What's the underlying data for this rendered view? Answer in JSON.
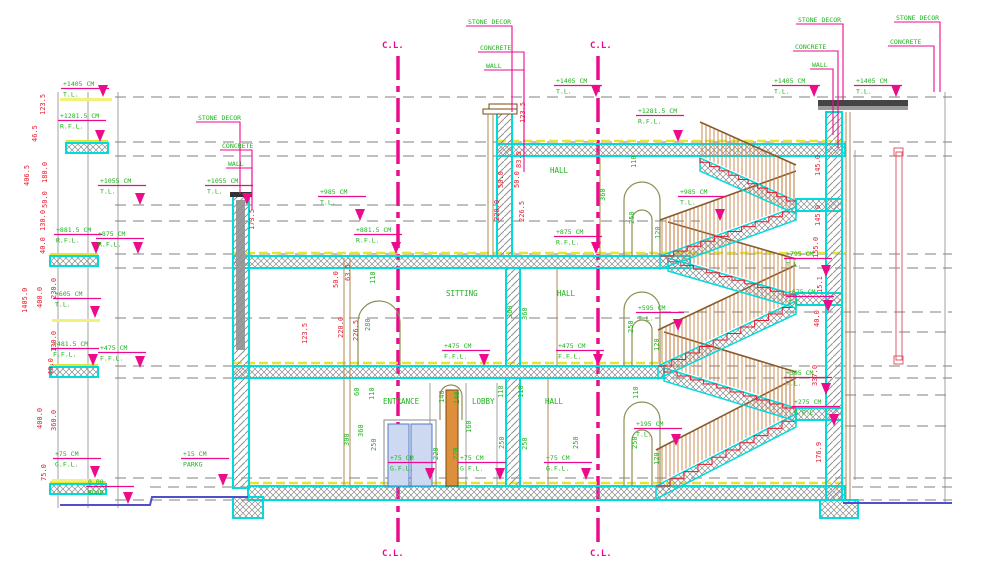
{
  "drawing": {
    "type": "architectural-section",
    "units": "CM"
  },
  "colors": {
    "level_text": "#1db31d",
    "dim_red": "#e8192c",
    "marker_magenta": "#ec0b8b",
    "slab_cyan": "#00dcdc",
    "floor_yellow": "#e4e432",
    "road_blue": "#5050c8",
    "stair_wood": "#c8834a",
    "column_orange": "#dd8f3c"
  },
  "centerlines": [
    {
      "t": "C.L.",
      "x": 382,
      "y": 48
    },
    {
      "t": "C.L.",
      "x": 590,
      "y": 48
    },
    {
      "t": "C.L.",
      "x": 382,
      "y": 556
    },
    {
      "t": "C.L.",
      "x": 590,
      "y": 556
    }
  ],
  "rooms": [
    {
      "t": "HALL",
      "x": 550,
      "y": 173
    },
    {
      "t": "SITTING",
      "x": 446,
      "y": 296
    },
    {
      "t": "HALL",
      "x": 557,
      "y": 296
    },
    {
      "t": "ENTRANCE",
      "x": 383,
      "y": 404
    },
    {
      "t": "LOBBY",
      "x": 472,
      "y": 404
    },
    {
      "t": "HALL",
      "x": 545,
      "y": 404
    }
  ],
  "levels": [
    {
      "v": "+1405 CM",
      "l": "T.L.",
      "x": 63,
      "y": 86,
      "ty": 97
    },
    {
      "v": "+1281.5 CM",
      "l": "R.F.L.",
      "x": 60,
      "y": 118,
      "ty": 142
    },
    {
      "v": "+1055 CM",
      "l": "T.L.",
      "x": 100,
      "y": 183,
      "ty": 205
    },
    {
      "v": "+1055 CM",
      "l": "T.L.",
      "x": 207,
      "y": 183,
      "ty": 205
    },
    {
      "v": "+881.5 CM",
      "l": "R.F.L.",
      "x": 56,
      "y": 232,
      "ty": 254
    },
    {
      "v": "+875 CM",
      "l": "R.F.L.",
      "x": 98,
      "y": 236,
      "ty": 254
    },
    {
      "v": "+605 CM",
      "l": "T.L.",
      "x": 55,
      "y": 296,
      "ty": 318
    },
    {
      "v": "+481.5 CM",
      "l": "F.F.L.",
      "x": 53,
      "y": 346,
      "ty": 366
    },
    {
      "v": "+475 CM",
      "l": "F.F.L.",
      "x": 100,
      "y": 350,
      "ty": 368
    },
    {
      "v": "+75 CM",
      "l": "G.F.L.",
      "x": 55,
      "y": 456,
      "ty": 478
    },
    {
      "v": "0.00",
      "l": "ROAD",
      "x": 88,
      "y": 484,
      "ty": 504
    },
    {
      "v": "+15 CM",
      "l": "PARKG",
      "x": 183,
      "y": 456,
      "ty": 486
    },
    {
      "v": "+1405 CM",
      "l": "T.L.",
      "x": 556,
      "y": 83,
      "ty": 97
    },
    {
      "v": "+1405 CM",
      "l": "T.L.",
      "x": 774,
      "y": 83,
      "ty": 97
    },
    {
      "v": "+1405 CM",
      "l": "T.L.",
      "x": 856,
      "y": 83,
      "ty": 97
    },
    {
      "v": "+1281.5 CM",
      "l": "R.F.L.",
      "x": 638,
      "y": 113,
      "ty": 142
    },
    {
      "v": "+985 CM",
      "l": "T.L.",
      "x": 320,
      "y": 194,
      "ty": 221
    },
    {
      "v": "+985 CM",
      "l": "T.L.",
      "x": 680,
      "y": 194,
      "ty": 221
    },
    {
      "v": "+881.5 CM",
      "l": "R.F.L.",
      "x": 356,
      "y": 232,
      "ty": 254
    },
    {
      "v": "+875 CM",
      "l": "R.F.L.",
      "x": 556,
      "y": 234,
      "ty": 254
    },
    {
      "v": "+795 CM",
      "l": "T.L.",
      "x": 786,
      "y": 256,
      "ty": 277
    },
    {
      "v": "+675 CM",
      "l": "T.L.",
      "x": 788,
      "y": 294,
      "ty": 312
    },
    {
      "v": "+595 CM",
      "l": "T.L.",
      "x": 638,
      "y": 310,
      "ty": 331
    },
    {
      "v": "+475 CM",
      "l": "F.F.L.",
      "x": 444,
      "y": 348,
      "ty": 366
    },
    {
      "v": "+475 CM",
      "l": "F.F.L.",
      "x": 558,
      "y": 348,
      "ty": 366
    },
    {
      "v": "+395 CM",
      "l": "T.L.",
      "x": 786,
      "y": 375,
      "ty": 395
    },
    {
      "v": "+275 CM",
      "l": "G.P.L.",
      "x": 794,
      "y": 404,
      "ty": 426
    },
    {
      "v": "+195 CM",
      "l": "T.L.",
      "x": 636,
      "y": 426,
      "ty": 446
    },
    {
      "v": "+75 CM",
      "l": "G.F.L.",
      "x": 390,
      "y": 460,
      "ty": 480
    },
    {
      "v": "+75 CM",
      "l": "G.F.L.",
      "x": 460,
      "y": 460,
      "ty": 480
    },
    {
      "v": "+75 CM",
      "l": "G.F.L.",
      "x": 546,
      "y": 460,
      "ty": 480
    }
  ],
  "leaders": [
    {
      "t": "STONE DECOR",
      "x": 468,
      "y": 24,
      "lx": 512,
      "ly": 112
    },
    {
      "t": "CONCRETE",
      "x": 480,
      "y": 50,
      "lx": 524,
      "ly": 146
    },
    {
      "t": "WALL",
      "x": 486,
      "y": 68,
      "lx": 524,
      "ly": 172
    },
    {
      "t": "STONE DECOR",
      "x": 798,
      "y": 22,
      "lx": 843,
      "ly": 100
    },
    {
      "t": "CONCRETE",
      "x": 795,
      "y": 49,
      "lx": 838,
      "ly": 148
    },
    {
      "t": "WALL",
      "x": 812,
      "y": 67,
      "lx": 833,
      "ly": 135
    },
    {
      "t": "STONE DECOR",
      "x": 896,
      "y": 20,
      "lx": 940,
      "ly": 92
    },
    {
      "t": "CONCRETE",
      "x": 890,
      "y": 44,
      "lx": 934,
      "ly": 92
    },
    {
      "t": "STONE DECOR",
      "x": 198,
      "y": 120,
      "lx": 240,
      "ly": 194
    },
    {
      "t": "CONCRETE",
      "x": 222,
      "y": 148,
      "lx": 252,
      "ly": 200
    },
    {
      "t": "WALL",
      "x": 228,
      "y": 166,
      "lx": 252,
      "ly": 210
    }
  ],
  "dims": [
    {
      "t": "123.5",
      "x": 45,
      "y": 115,
      "c": "r"
    },
    {
      "t": "46.5",
      "x": 37,
      "y": 142,
      "c": "r"
    },
    {
      "t": "180.0",
      "x": 47,
      "y": 183,
      "c": "r"
    },
    {
      "t": "406.5",
      "x": 29,
      "y": 186,
      "c": "r"
    },
    {
      "t": "50.0",
      "x": 47,
      "y": 208,
      "c": "r"
    },
    {
      "t": "130.0",
      "x": 45,
      "y": 231,
      "c": "r"
    },
    {
      "t": "40.0",
      "x": 45,
      "y": 254,
      "c": "r"
    },
    {
      "t": "1405.0",
      "x": 27,
      "y": 313,
      "c": "r"
    },
    {
      "t": "400.0",
      "x": 42,
      "y": 308,
      "c": "r"
    },
    {
      "t": "230.0",
      "x": 56,
      "y": 299,
      "c": "r"
    },
    {
      "t": "130.0",
      "x": 56,
      "y": 352,
      "c": "r"
    },
    {
      "t": "40.0",
      "x": 53,
      "y": 375,
      "c": "r"
    },
    {
      "t": "400.0",
      "x": 42,
      "y": 429,
      "c": "r"
    },
    {
      "t": "360.0",
      "x": 56,
      "y": 431,
      "c": "r"
    },
    {
      "t": "75.0",
      "x": 46,
      "y": 481,
      "c": "r"
    },
    {
      "t": "145.0",
      "x": 820,
      "y": 176,
      "c": "r"
    },
    {
      "t": "145.0",
      "x": 820,
      "y": 226,
      "c": "r"
    },
    {
      "t": "155.0",
      "x": 818,
      "y": 258,
      "c": "r"
    },
    {
      "t": "15.1",
      "x": 822,
      "y": 293,
      "c": "r"
    },
    {
      "t": "40.0",
      "x": 819,
      "y": 327,
      "c": "r"
    },
    {
      "t": "337.0",
      "x": 817,
      "y": 386,
      "c": "r"
    },
    {
      "t": "176.9",
      "x": 821,
      "y": 463,
      "c": "r"
    },
    {
      "t": "123.5",
      "x": 525,
      "y": 123,
      "c": "r"
    },
    {
      "t": "83.5",
      "x": 521,
      "y": 168,
      "c": "r"
    },
    {
      "t": "50.0",
      "x": 503,
      "y": 188,
      "c": "r"
    },
    {
      "t": "50.0",
      "x": 519,
      "y": 188,
      "c": "r"
    },
    {
      "t": "220.0",
      "x": 499,
      "y": 221,
      "c": "r"
    },
    {
      "t": "226.5",
      "x": 524,
      "y": 222,
      "c": "r"
    },
    {
      "t": "110",
      "x": 636,
      "y": 168,
      "c": "g"
    },
    {
      "t": "360",
      "x": 605,
      "y": 201,
      "c": "g"
    },
    {
      "t": "250",
      "x": 634,
      "y": 224,
      "c": "g"
    },
    {
      "t": "120",
      "x": 660,
      "y": 239,
      "c": "g"
    },
    {
      "t": "173.5",
      "x": 254,
      "y": 230,
      "c": "r"
    },
    {
      "t": "123.5",
      "x": 307,
      "y": 344,
      "c": "r"
    },
    {
      "t": "220.0",
      "x": 343,
      "y": 338,
      "c": "r"
    },
    {
      "t": "226.5",
      "x": 358,
      "y": 341,
      "c": "r"
    },
    {
      "t": "50.0",
      "x": 338,
      "y": 288,
      "c": "r"
    },
    {
      "t": "63.5",
      "x": 350,
      "y": 281,
      "c": "r"
    },
    {
      "t": "280",
      "x": 370,
      "y": 331,
      "c": "g"
    },
    {
      "t": "110",
      "x": 375,
      "y": 284,
      "c": "g"
    },
    {
      "t": "360",
      "x": 512,
      "y": 318,
      "c": "g"
    },
    {
      "t": "360",
      "x": 527,
      "y": 320,
      "c": "g"
    },
    {
      "t": "250",
      "x": 633,
      "y": 333,
      "c": "g"
    },
    {
      "t": "120",
      "x": 659,
      "y": 351,
      "c": "g"
    },
    {
      "t": "60",
      "x": 359,
      "y": 396,
      "c": "g"
    },
    {
      "t": "110",
      "x": 374,
      "y": 400,
      "c": "g"
    },
    {
      "t": "300",
      "x": 349,
      "y": 446,
      "c": "g"
    },
    {
      "t": "360",
      "x": 363,
      "y": 437,
      "c": "g"
    },
    {
      "t": "250",
      "x": 376,
      "y": 451,
      "c": "g"
    },
    {
      "t": "140",
      "x": 444,
      "y": 403,
      "c": "g"
    },
    {
      "t": "140",
      "x": 459,
      "y": 404,
      "c": "g"
    },
    {
      "t": "220",
      "x": 438,
      "y": 460,
      "c": "g"
    },
    {
      "t": "220",
      "x": 458,
      "y": 460,
      "c": "g"
    },
    {
      "t": "160",
      "x": 471,
      "y": 433,
      "c": "g"
    },
    {
      "t": "110",
      "x": 503,
      "y": 398,
      "c": "g"
    },
    {
      "t": "250",
      "x": 504,
      "y": 449,
      "c": "g"
    },
    {
      "t": "110",
      "x": 523,
      "y": 398,
      "c": "g"
    },
    {
      "t": "250",
      "x": 527,
      "y": 450,
      "c": "g"
    },
    {
      "t": "250",
      "x": 578,
      "y": 449,
      "c": "g"
    },
    {
      "t": "110",
      "x": 638,
      "y": 399,
      "c": "g"
    },
    {
      "t": "250",
      "x": 637,
      "y": 449,
      "c": "g"
    },
    {
      "t": "120",
      "x": 659,
      "y": 465,
      "c": "g"
    }
  ]
}
